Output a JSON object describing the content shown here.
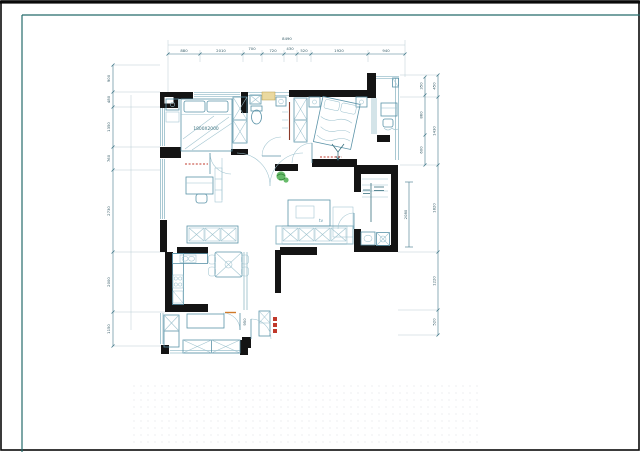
{
  "labels": {
    "bed_size": "1800X2000",
    "tv": "tv",
    "entry_door": "950"
  },
  "dims": {
    "top": {
      "total": "8490",
      "segments": [
        "880",
        "2010",
        "700",
        "720",
        "430",
        "520",
        "1920",
        "940"
      ]
    },
    "left": {
      "segments": [
        "900",
        "480",
        "1350",
        "760",
        "2730",
        "2000",
        "1150"
      ]
    },
    "right_outer": {
      "segments": [
        "450",
        "1430",
        "1820",
        "1220",
        "520"
      ]
    },
    "right_balcony": {
      "segments": [
        "350",
        "860",
        "600"
      ]
    },
    "right_bath": {
      "value": "2080"
    }
  },
  "colors": {
    "sheet_frame": "#256b6b",
    "wall": "#141414",
    "furniture": "#5b93a8",
    "dimension": "#43798a",
    "plant": "#44a94c",
    "accent_red": "#c23b2e",
    "accent_orange": "#d07a2a",
    "accent_beige": "#ead9a0"
  }
}
